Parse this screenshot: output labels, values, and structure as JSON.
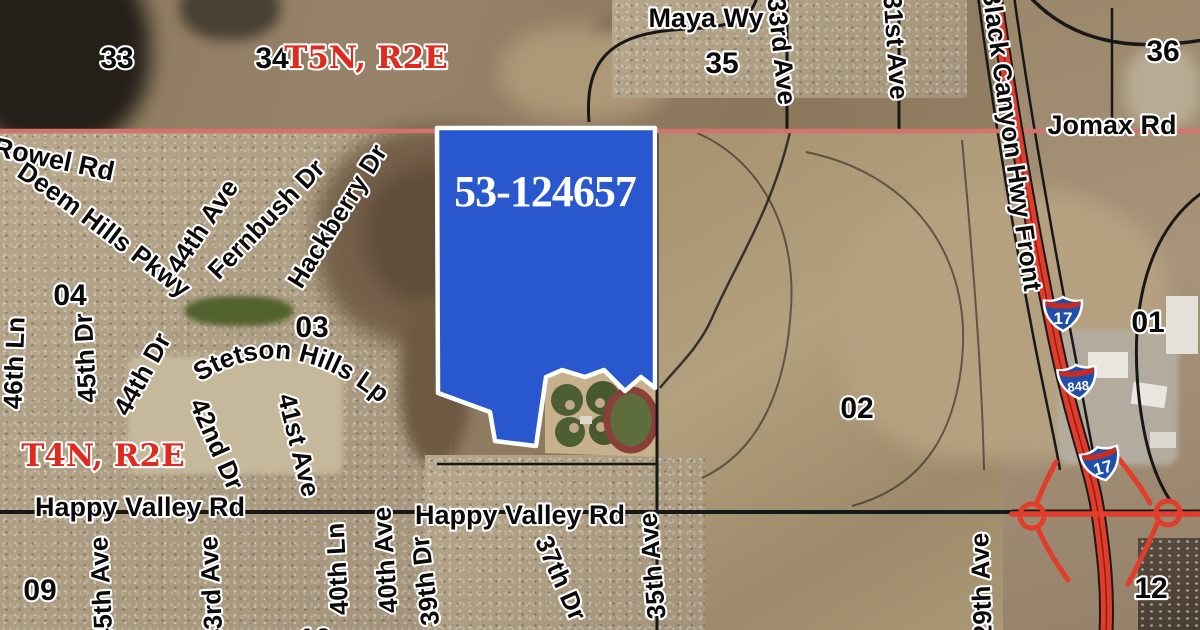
{
  "parcel": {
    "apn": "53-124657"
  },
  "townships": {
    "t5n": "T5N, R2E",
    "t4n": "T4N, R2E"
  },
  "sections": {
    "s33": "33",
    "s34": "34",
    "s35": "35",
    "s36": "36",
    "s04": "04",
    "s03": "03",
    "s02": "02",
    "s01": "01",
    "s09": "09",
    "s10": "10",
    "s12": "12"
  },
  "roads": {
    "maya": "Maya Wy",
    "jomax": "Jomax Rd",
    "rowel": "Rowel Rd",
    "blackCanyon": "Black Canyon Hwy Front",
    "deemHills": "Deem Hills Pkwy",
    "ave44": "44th Ave",
    "fernbush": "Fernbush Dr",
    "hackberry": "Hackberry Dr",
    "ln46": "46th Ln",
    "dr45": "45th Dr",
    "dr44": "44th Dr",
    "stetson": "Stetson Hills Lp",
    "dr42": "42nd Dr",
    "ave41": "41st Ave",
    "ave33": "33rd Ave",
    "ave31": "31st Ave",
    "happyValleyLeft": "Happy Valley Rd",
    "happyValleyRight": "Happy Valley Rd",
    "ave45": "45th Ave",
    "ave43": "43rd Ave",
    "ln40": "40th Ln",
    "ave40": "40th Ave",
    "dr39": "39th Dr",
    "dr37": "37th Dr",
    "ave35": "35th Ave",
    "ave29": "29th Ave"
  },
  "shields": {
    "i17": "17",
    "i848": "848"
  },
  "colors": {
    "parcel": "#2957cd",
    "townshipLine": "#d4736b",
    "freeway": "#e23c2b",
    "labelRed": "#e02a1e"
  }
}
